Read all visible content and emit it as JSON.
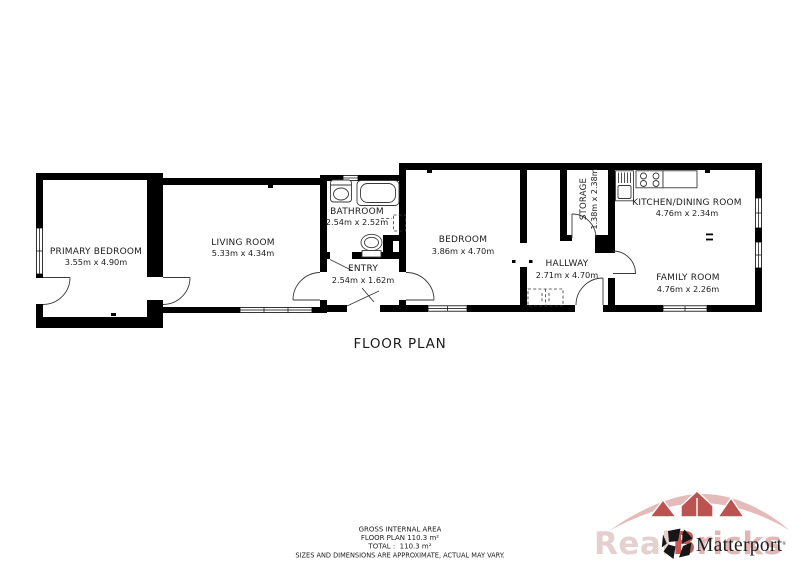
{
  "title": "FLOOR PLAN",
  "rooms": {
    "primary_bedroom": {
      "name": "PRIMARY BEDROOM",
      "dims": "3.55m x 4.90m"
    },
    "living_room": {
      "name": "LIVING ROOM",
      "dims": "5.33m x 4.34m"
    },
    "bathroom": {
      "name": "BATHROOM",
      "dims": "2.54m x 2.52m"
    },
    "entry": {
      "name": "ENTRY",
      "dims": "2.54m x 1.62m"
    },
    "bedroom": {
      "name": "BEDROOM",
      "dims": "3.86m x 4.70m"
    },
    "storage": {
      "name": "STORAGE",
      "dims": "1.38m x 2.38m"
    },
    "hallway": {
      "name": "HALLWAY",
      "dims": "2.71m x 4.70m"
    },
    "kitchen_dining": {
      "name": "KITCHEN/DINING ROOM",
      "dims": "4.76m x 2.34m"
    },
    "family_room": {
      "name": "FAMILY ROOM",
      "dims": "4.76m x 2.26m"
    }
  },
  "footer": {
    "line1": "GROSS INTERNAL AREA",
    "line2": "FLOOR PLAN 110.3 m²",
    "line3": "TOTAL :  110.3 m²",
    "disclaimer": "SIZES AND DIMENSIONS ARE APPROXIMATE, ACTUAL MAY VARY."
  },
  "branding": {
    "matterport_label": "Matterport",
    "reg_mark": "®",
    "watermark_part1": "Real",
    "watermark_part2": "B",
    "watermark_part3": "ricks",
    "colors": {
      "watermark_light_pink": "#e2cbc9",
      "watermark_pink": "#ddb0ae",
      "watermark_red": "#b5413f",
      "logo_black": "#161616",
      "label_ink": "#1c1c1c",
      "disclaimer_gray": "#6f6f6f"
    }
  }
}
